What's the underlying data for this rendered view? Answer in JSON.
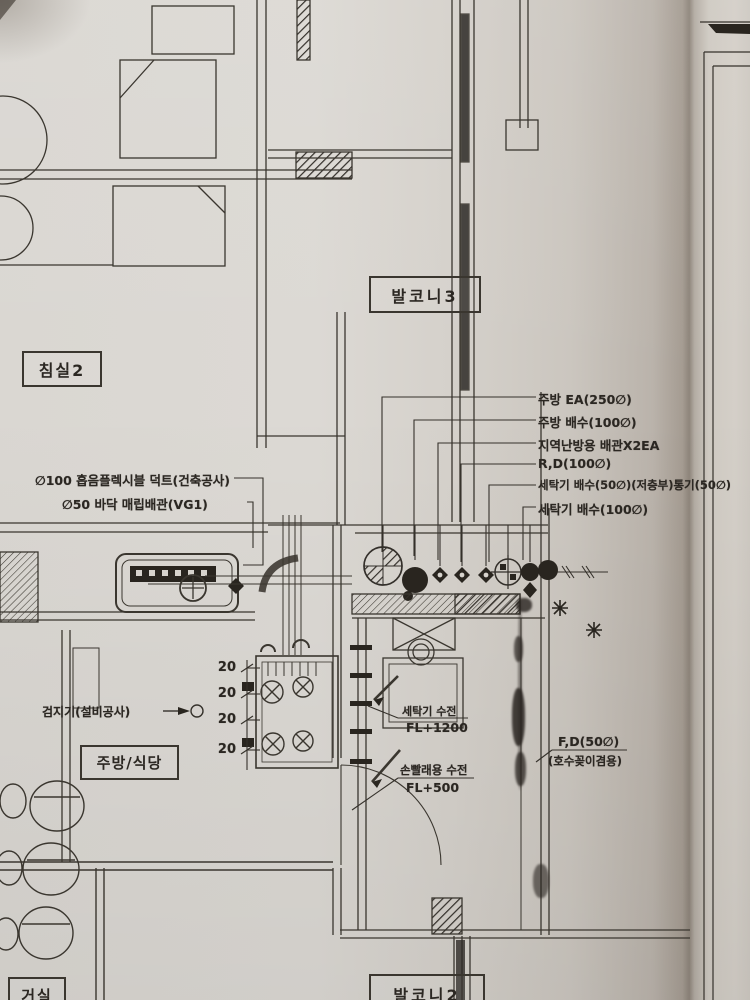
{
  "labels": {
    "balcony3": "발코니3",
    "bedroom2": "침실2",
    "kitchen_dining": "주방/식당",
    "balcony2": "발코니2",
    "living_room": "거실"
  },
  "pipe_annotations": {
    "right": [
      "주방 EA(250∅)",
      "주방 배수(100∅)",
      "지역난방용 배관X2EA",
      "R,D(100∅)",
      "세탁기 배수(50∅)(저층부)통기(50∅)",
      "세탁기 배수(100∅)"
    ],
    "left": [
      "∅100 흡음플렉시블 덕트(건축공사)",
      "∅50 바닥 매립배관(VG1)"
    ],
    "detector": "검지기(설비공사)",
    "floor_drain": "F,D(50∅)",
    "floor_drain_note": "(호수꽂이겸용)"
  },
  "fixtures": {
    "washer_faucet": "세탁기 수전",
    "washer_faucet_height": "FL+1200",
    "handwash_faucet": "손빨래용 수전",
    "handwash_faucet_height": "FL+500"
  },
  "dimensions": {
    "ticks": [
      "20",
      "20",
      "20",
      "20"
    ]
  },
  "colors": {
    "paper": "#d7d3cd",
    "ink": "#332f2a"
  }
}
